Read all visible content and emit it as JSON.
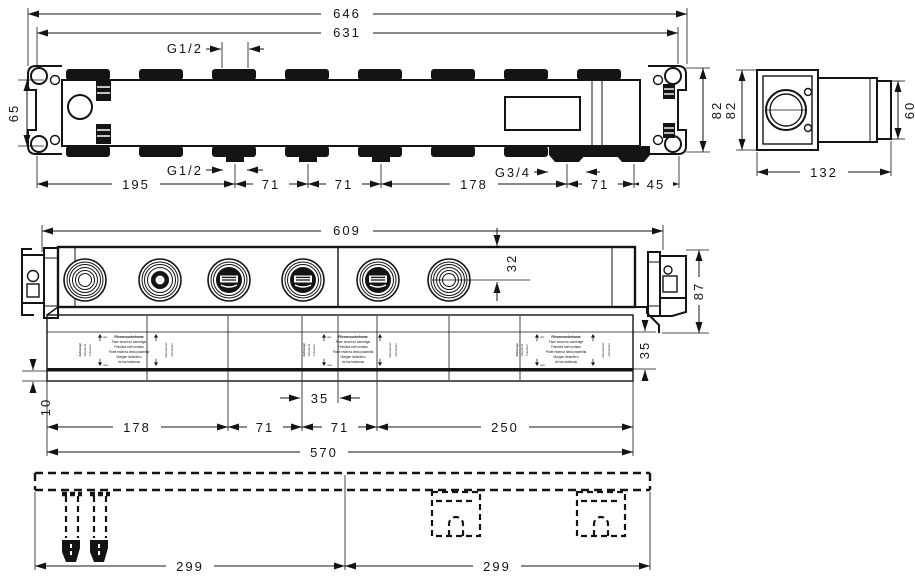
{
  "meta": {
    "bg": "#ffffff",
    "ink": "#141414"
  },
  "top_view": {
    "dim_total": "646",
    "dim_body": "631",
    "dim_height_left": "65",
    "dim_height_right": "82",
    "thread_top": "G1/2",
    "thread_bottom": "G1/2",
    "thread_outlet": "G3/4",
    "chain": [
      "195",
      "71",
      "71",
      "178",
      "71",
      "45"
    ]
  },
  "side_view": {
    "dim_height": "82",
    "dim_spigot": "60",
    "dim_depth": "132"
  },
  "front_view": {
    "dim_width": "609",
    "dim_port_offset": "32",
    "dim_end_height": "87",
    "dim_strip_height": "35",
    "dim_center_offset": "35",
    "dim_wall_gap": "10",
    "dim_total": "570",
    "chain": [
      "178",
      "71",
      "71",
      "250"
    ],
    "strip": {
      "line1": "Fliesenvorderkante",
      "line2": "Face avant du carrelage",
      "line3": "Finished wall surface",
      "line4": "Parte esterna della piastrella",
      "line5": "Margen delantero",
      "line6": "de las baldosas",
      "min": "min.",
      "max": "max.",
      "side1": "Achtung!",
      "side2": "Attention!",
      "side3": "Caution!",
      "side4": "Attenzione!",
      "side5": "¡Atención!"
    }
  },
  "bottom_view": {
    "dim_left": "299",
    "dim_right": "299"
  }
}
